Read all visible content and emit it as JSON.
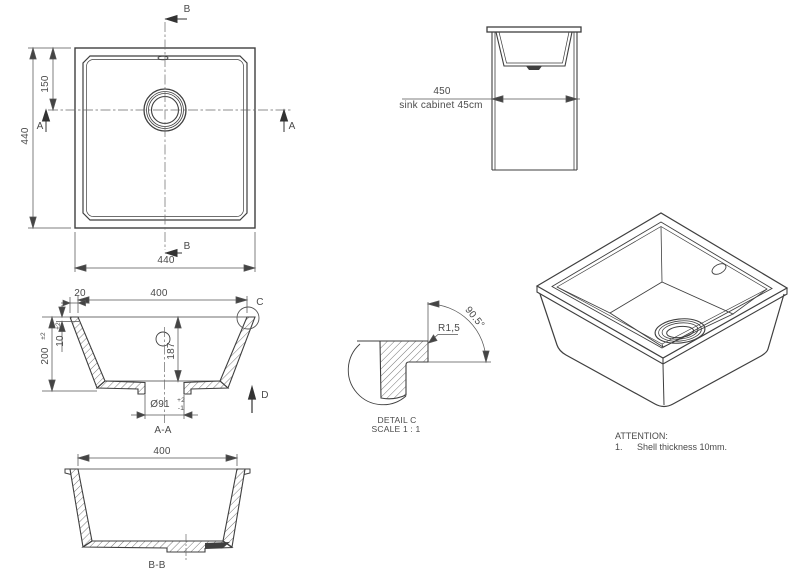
{
  "colors": {
    "line": "#3f3f3f",
    "text": "#4a4a4a",
    "background": "#ffffff"
  },
  "top_view": {
    "section_b_top": "B",
    "section_b_bottom": "B",
    "section_a_left": "A",
    "section_a_right": "A",
    "dim_width_bottom": "440",
    "dim_height_left": "440",
    "dim_drain_from_top": "150"
  },
  "cabinet_view": {
    "dim_width": "450",
    "caption": "sink cabinet 45cm"
  },
  "section_aa": {
    "label": "A-A",
    "dim_top_opening": "400",
    "dim_flange_width": "20",
    "dim_overall_height": "200",
    "dim_overall_height_tol": "±2",
    "dim_flange_thickness": "10",
    "dim_flange_thickness_tol": "±2",
    "dim_inner_depth": "187",
    "dim_drain_diameter": "Ø91",
    "dim_drain_tol_upper": "+2",
    "dim_drain_tol_lower": "-1",
    "detail_marker": "C",
    "datum_marker": "D"
  },
  "section_bb": {
    "label": "B-B",
    "dim_top_opening": "400"
  },
  "detail_c": {
    "radius": "R1,5",
    "angle": "90.5°",
    "title": "DETAIL C",
    "scale": "SCALE 1 : 1"
  },
  "attention": {
    "title": "ATTENTION:",
    "item_number": "1.",
    "item_text": "Shell thickness 10mm."
  }
}
